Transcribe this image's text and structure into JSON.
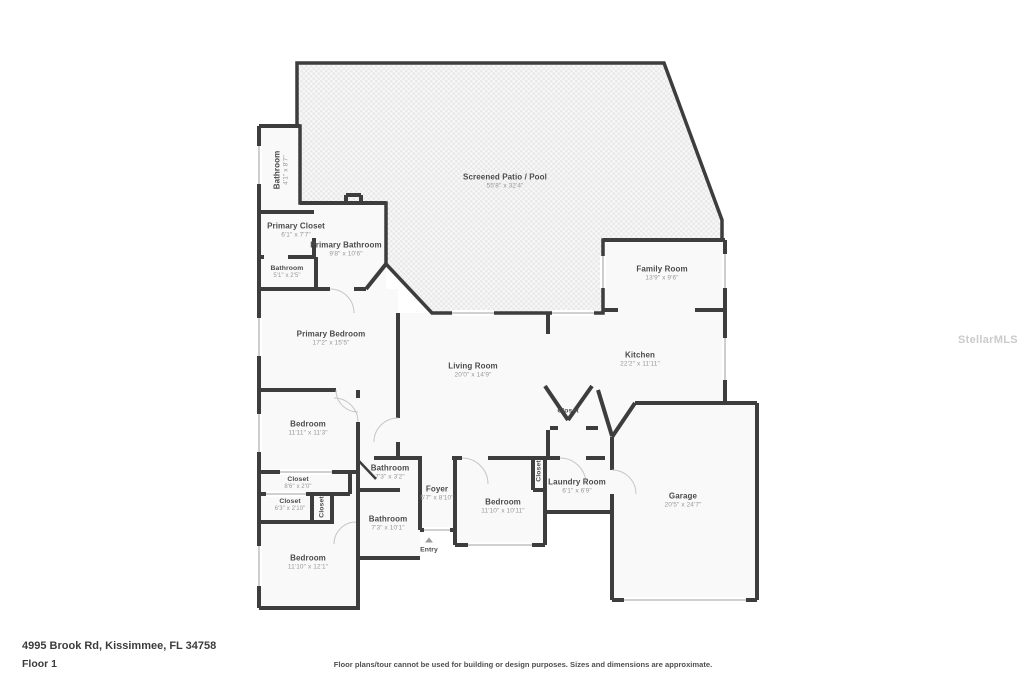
{
  "watermark": "StellarMLS",
  "footer": {
    "address": "4995 Brook Rd, Kissimmee, FL 34758",
    "floor": "Floor 1",
    "disclaimer": "Floor plans/tour cannot be used for building or design purposes. Sizes and dimensions are approximate."
  },
  "colors": {
    "walls": "#3d3d3d",
    "room_fill": "#f9f9f9",
    "patio_hatch": "#e9e9e9",
    "label_text": "#4b4b4b",
    "dims_text": "#989898"
  },
  "rooms": [
    {
      "name": "Screened Patio / Pool",
      "dims": "55'8\" x 32'4\""
    },
    {
      "name": "Bathroom",
      "dims": "4'1\" x 8'7\""
    },
    {
      "name": "Primary Closet",
      "dims": "6'1\" x 7'7\""
    },
    {
      "name": "Primary Bathroom",
      "dims": "9'8\" x 10'6\""
    },
    {
      "name": "Bathroom",
      "dims": "5'1\" x 2'5\""
    },
    {
      "name": "Primary Bedroom",
      "dims": "17'2\" x 15'5\""
    },
    {
      "name": "Living Room",
      "dims": "20'0\" x 14'9\""
    },
    {
      "name": "Family Room",
      "dims": "13'9\" x 9'6\""
    },
    {
      "name": "Kitchen",
      "dims": "22'2\" x 11'11\""
    },
    {
      "name": "Closet"
    },
    {
      "name": "Bedroom",
      "dims": "11'11\" x 11'3\""
    },
    {
      "name": "Closet",
      "dims": "8'6\" x 2'0\""
    },
    {
      "name": "Closet",
      "dims": "6'3\" x 2'10\""
    },
    {
      "name": "Closet"
    },
    {
      "name": "Bathroom",
      "dims": "7'3\" x 3'2\""
    },
    {
      "name": "Foyer",
      "dims": "5'7\" x 8'10\""
    },
    {
      "name": "Bedroom",
      "dims": "11'10\" x 10'11\""
    },
    {
      "name": "Laundry Room",
      "dims": "6'1\" x 6'9\""
    },
    {
      "name": "Closet"
    },
    {
      "name": "Garage",
      "dims": "20'5\" x 24'7\""
    },
    {
      "name": "Bathroom",
      "dims": "7'3\" x 10'1\""
    },
    {
      "name": "Bedroom",
      "dims": "11'10\" x 12'1\""
    },
    {
      "name": "Entry"
    }
  ]
}
